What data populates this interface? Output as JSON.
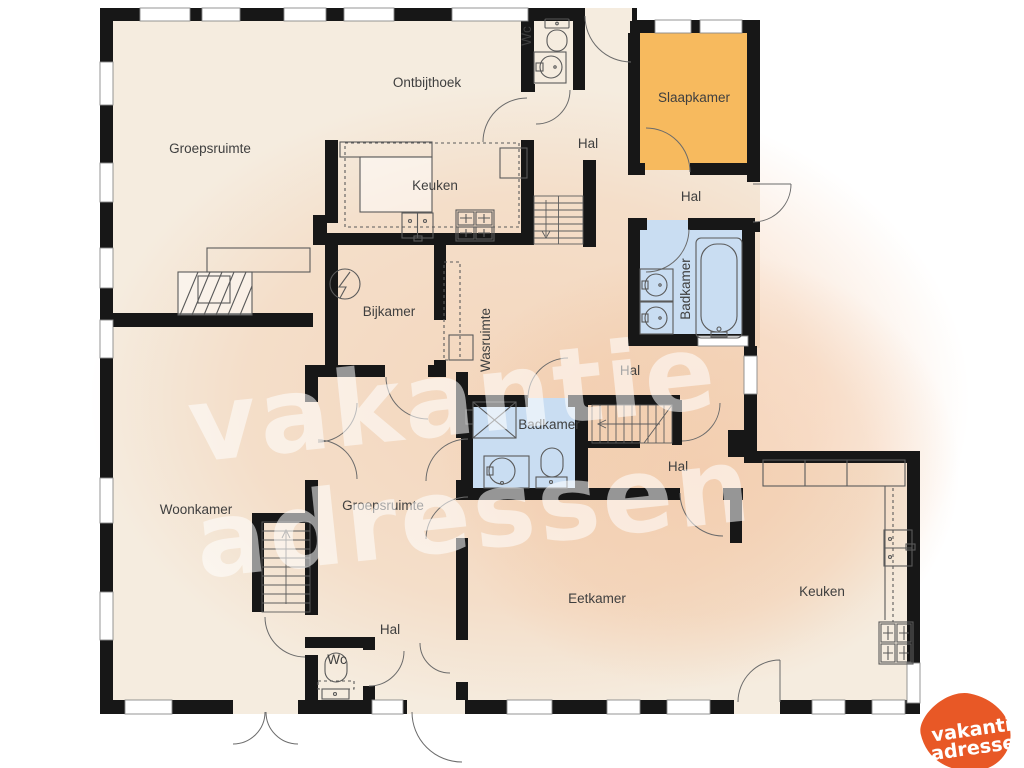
{
  "colors": {
    "floor": "#f5ecdf",
    "wall": "#171717",
    "bedroom": "#f7ba5e",
    "bathroom": "#c9ddf2",
    "fixture": "#5a5a5a",
    "label": "#3f3f3f",
    "tint": "#f2c4a0",
    "watermark": "rgba(255,255,255,0.55)",
    "logo_orange": "#e85826",
    "logo_text": "#ffffff"
  },
  "rooms": [
    {
      "id": "ontbijthoek",
      "label": "Ontbijthoek"
    },
    {
      "id": "groepsruimte-boven",
      "label": "Groepsruimte"
    },
    {
      "id": "keuken-boven",
      "label": "Keuken"
    },
    {
      "id": "wc-boven",
      "label": "Wc"
    },
    {
      "id": "hal-boven",
      "label": "Hal"
    },
    {
      "id": "slaapkamer",
      "label": "Slaapkamer"
    },
    {
      "id": "hal-rechtsboven",
      "label": "Hal"
    },
    {
      "id": "badkamer-rechts",
      "label": "Badkamer"
    },
    {
      "id": "bijkamer",
      "label": "Bijkamer"
    },
    {
      "id": "wasruimte",
      "label": "Wasruimte"
    },
    {
      "id": "hal-midden",
      "label": "Hal"
    },
    {
      "id": "badkamer-midden",
      "label": "Badkamer"
    },
    {
      "id": "hal-rechts",
      "label": "Hal"
    },
    {
      "id": "woonkamer",
      "label": "Woonkamer"
    },
    {
      "id": "groepsruimte-midden",
      "label": "Groepsruimte"
    },
    {
      "id": "eetkamer",
      "label": "Eetkamer"
    },
    {
      "id": "keuken-beneden",
      "label": "Keuken"
    },
    {
      "id": "hal-beneden",
      "label": "Hal"
    },
    {
      "id": "wc-beneden",
      "label": "Wc"
    }
  ],
  "watermark": {
    "line1": "vakantie",
    "line2": "adressen"
  },
  "logo": {
    "line1": "vakantie",
    "line2": "adressen"
  }
}
